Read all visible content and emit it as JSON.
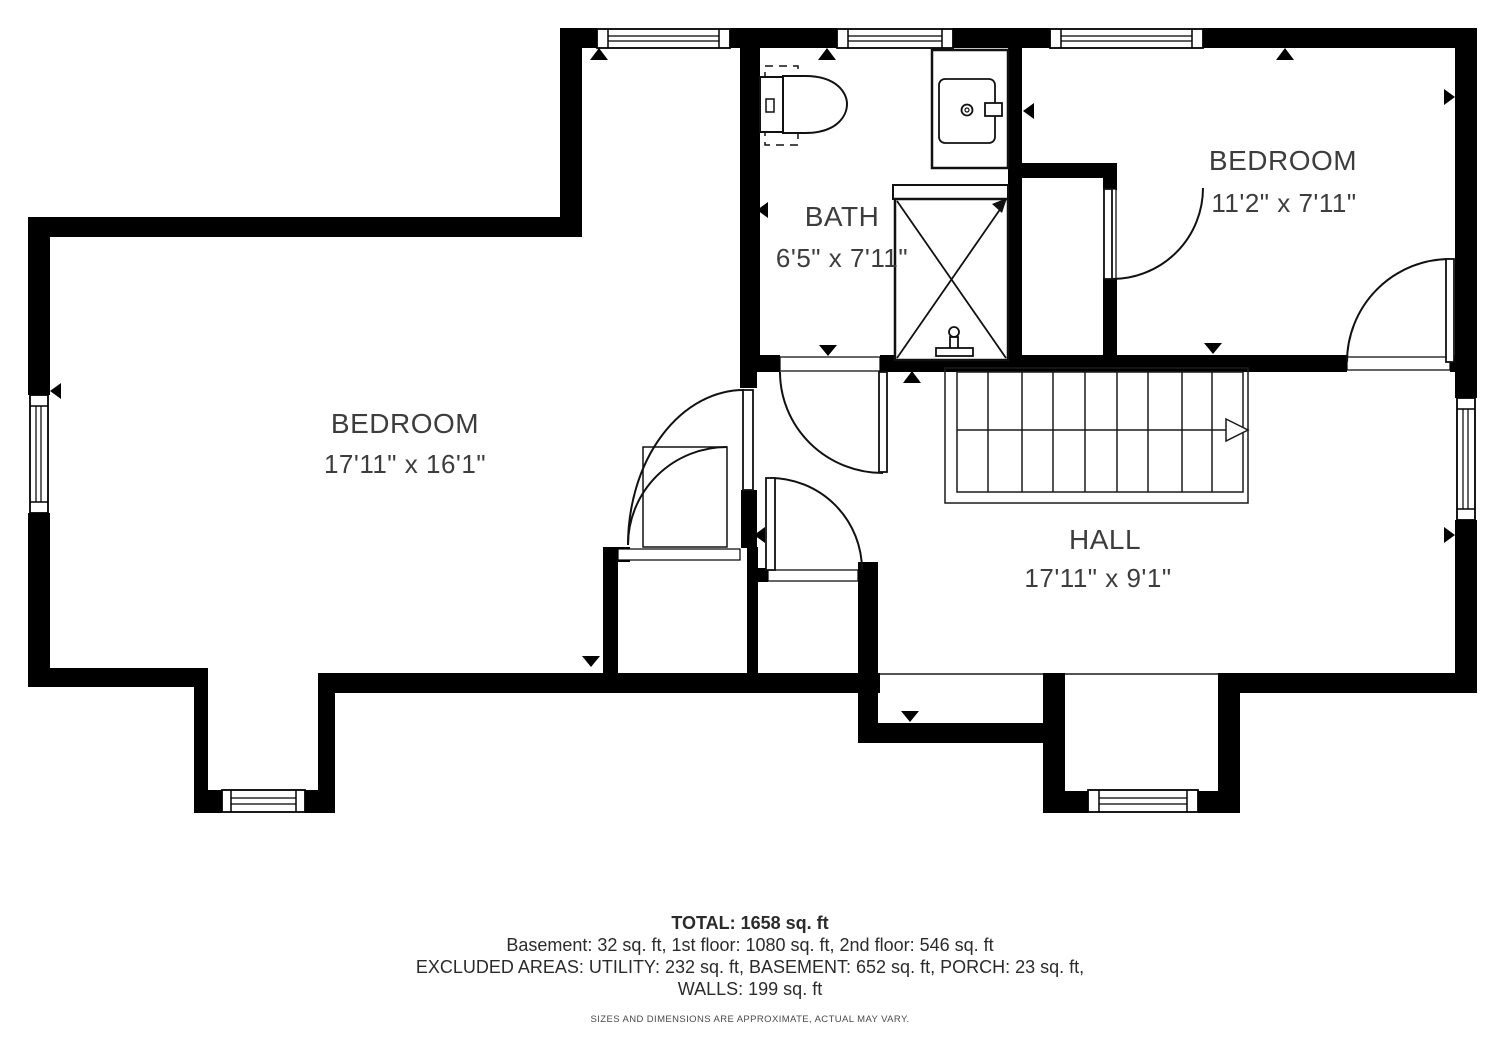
{
  "colors": {
    "wall": "#000000",
    "line": "#1a1a1a",
    "text": "#3d3d3d",
    "background": "#ffffff"
  },
  "rooms": [
    {
      "id": "bath",
      "name": "BATH",
      "dims": "6'5\" x 7'11\""
    },
    {
      "id": "bedroom-right",
      "name": "BEDROOM",
      "dims": "11'2\" x 7'11\""
    },
    {
      "id": "bedroom-left",
      "name": "BEDROOM",
      "dims": "17'11\" x 16'1\""
    },
    {
      "id": "hall",
      "name": "HALL",
      "dims": "17'11\" x 9'1\""
    }
  ],
  "fixtures": [
    "toilet-icon",
    "vanity-sink-icon",
    "shower-icon",
    "staircase-icon"
  ],
  "summary": {
    "total": "TOTAL: 1658 sq. ft",
    "floors": "Basement: 32 sq. ft, 1st floor: 1080 sq. ft, 2nd floor: 546 sq. ft",
    "excluded": "EXCLUDED AREAS: UTILITY: 232 sq. ft, BASEMENT: 652 sq. ft, PORCH: 23 sq. ft,",
    "walls": "WALLS: 199 sq. ft",
    "disclaimer": "SIZES AND DIMENSIONS ARE APPROXIMATE, ACTUAL MAY VARY."
  }
}
